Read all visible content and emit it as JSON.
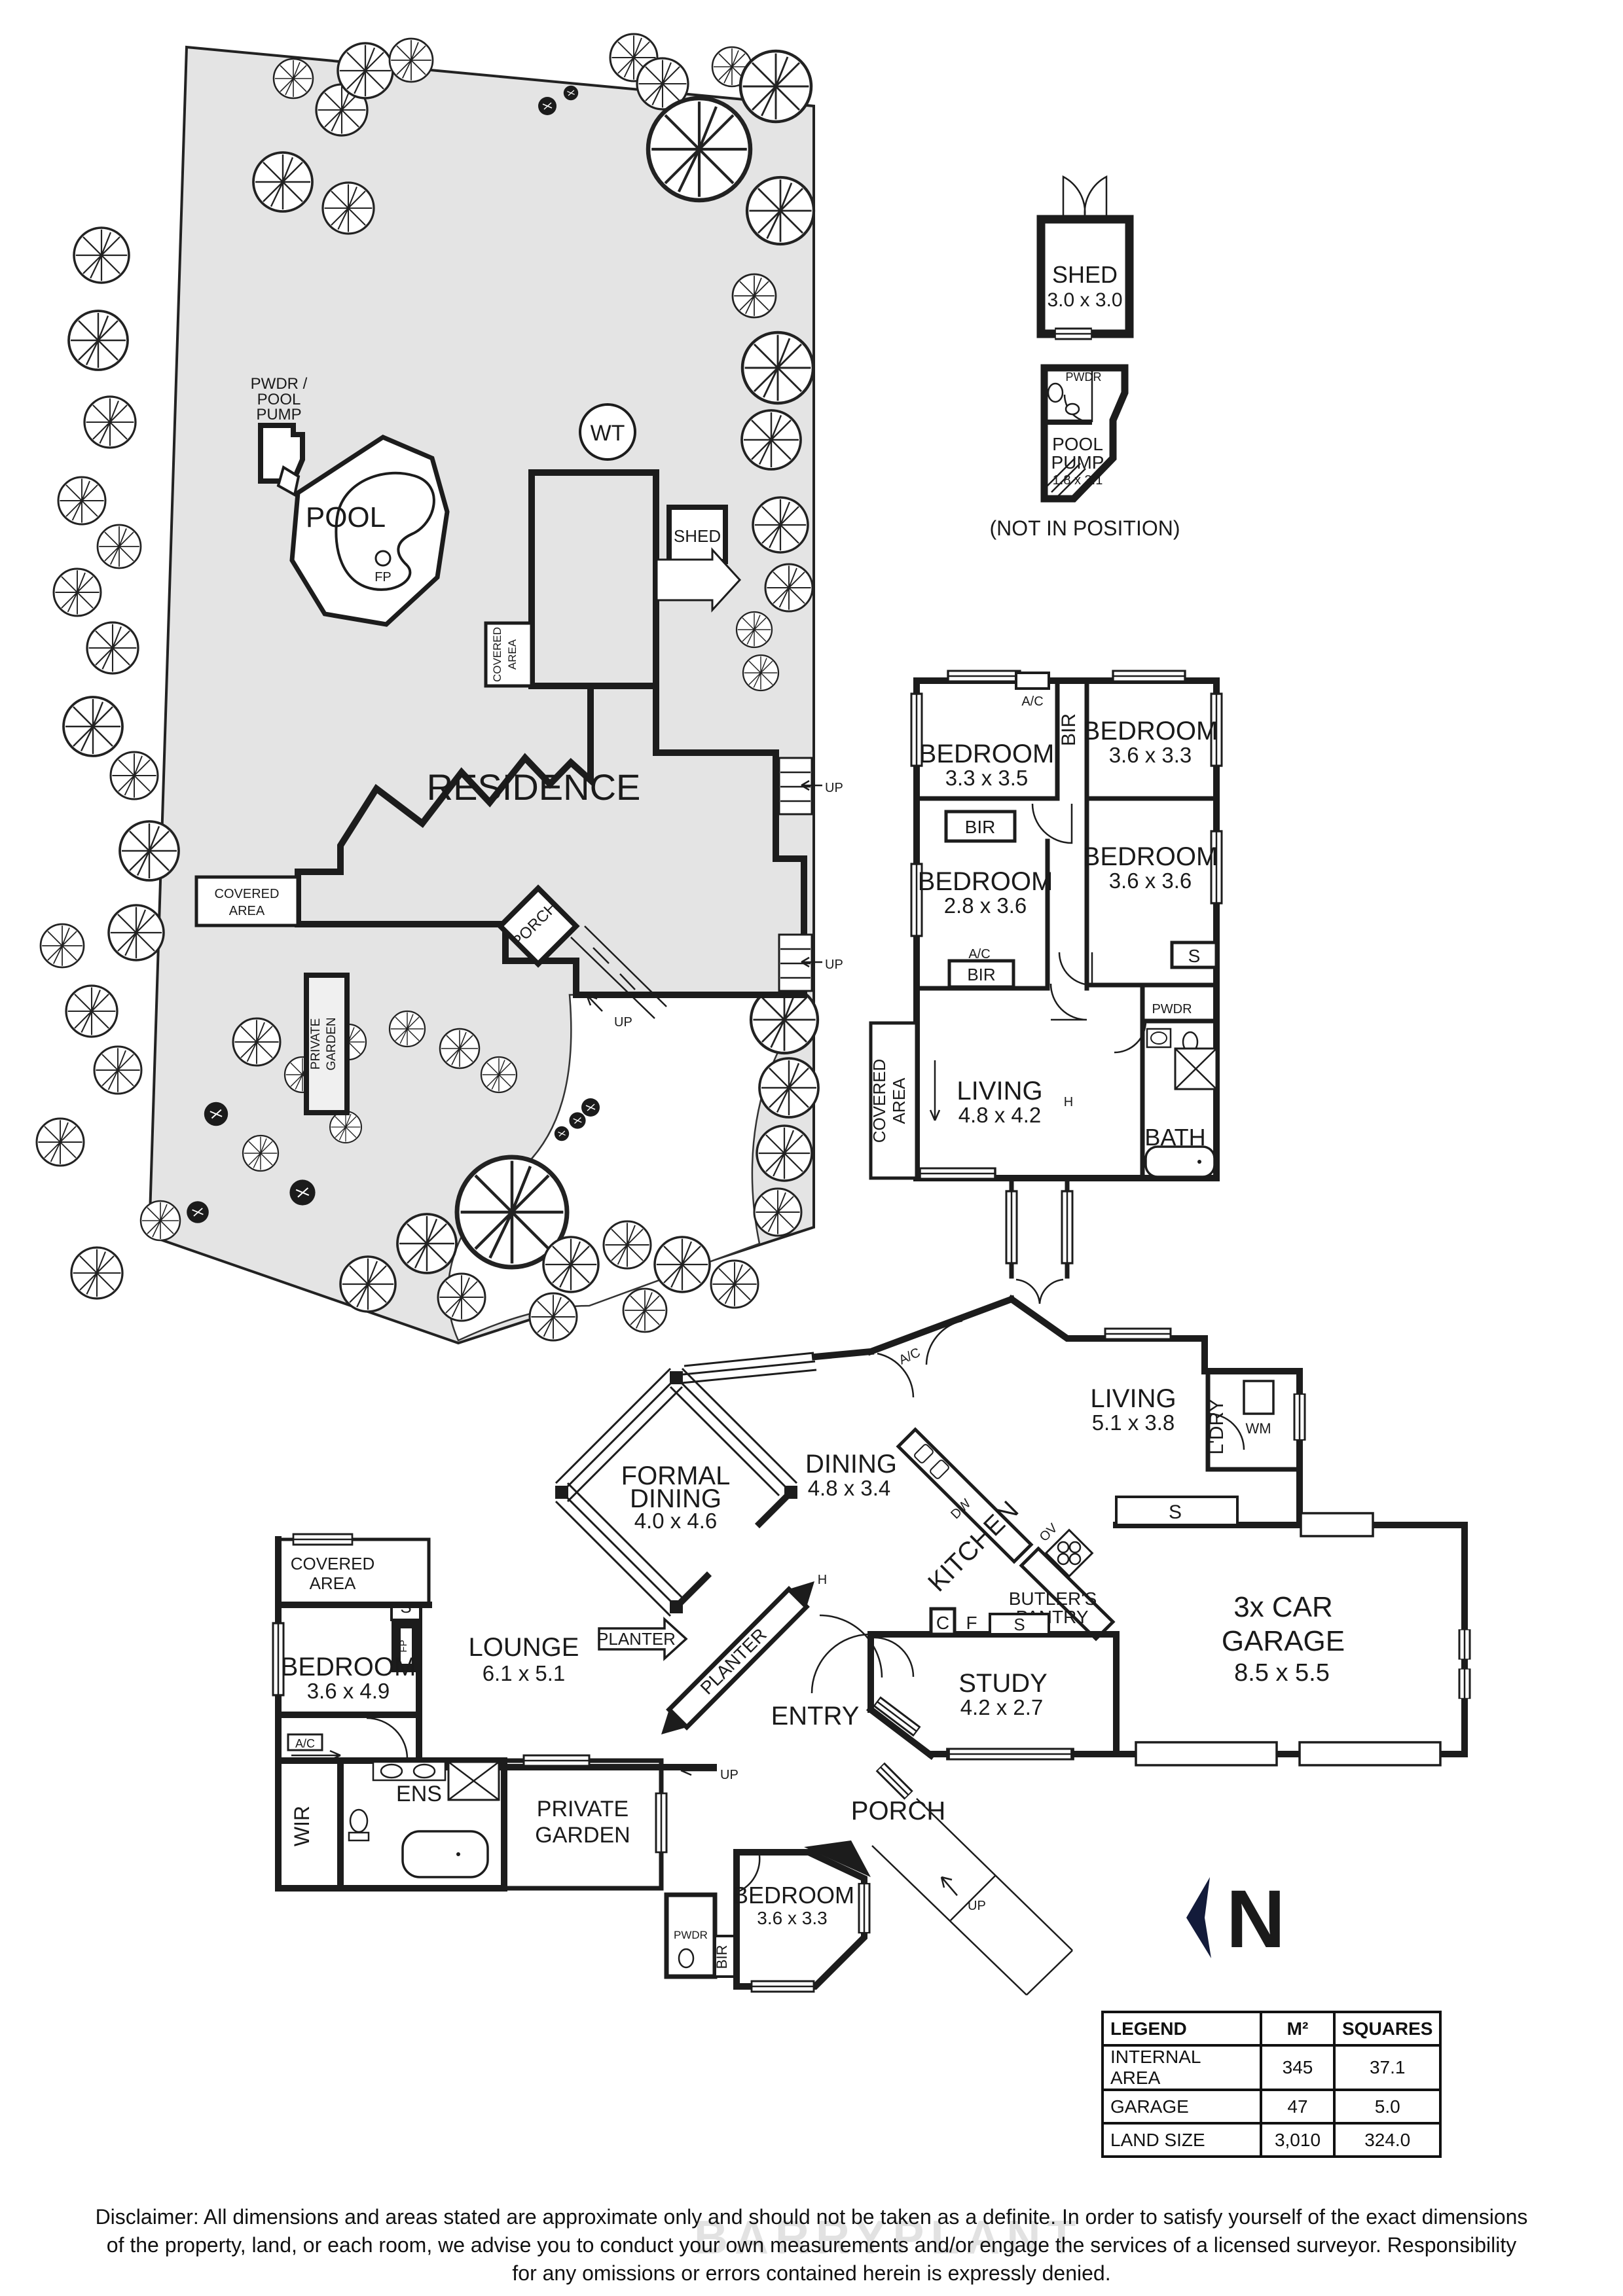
{
  "site": {
    "residence": "RESIDENCE",
    "pool": "POOL",
    "wt": "WT",
    "shed": "SHED",
    "fp": "FP",
    "pwdr_pump": [
      "PWDR /",
      "POOL",
      "PUMP"
    ],
    "covered": [
      "COVERED",
      "AREA"
    ],
    "private_garden": [
      "PRIVATE",
      "GARDEN"
    ],
    "porch": "PORCH",
    "up": "UP"
  },
  "outbuildings": {
    "shed_name": "SHED",
    "shed_dims": "3.0 x 3.0",
    "pump_name": [
      "POOL",
      "PUMP"
    ],
    "pump_dims": "1.8 x 3.1",
    "pwdr": "PWDR",
    "note": "(NOT IN POSITION)"
  },
  "wing": {
    "bedroom": "BEDROOM",
    "bed1_dims": "3.3 x 3.5",
    "bed2_dims": "3.6 x 3.3",
    "bed3_dims": "2.8 x 3.6",
    "bed4_dims": "3.6 x 3.6",
    "living": "LIVING",
    "living_dims": "4.8 x 4.2",
    "bath": "BATH",
    "bir": "BIR",
    "ac": "A/C",
    "s": "S",
    "pwdr": "PWDR",
    "h": "H",
    "covered": [
      "COVERED",
      "AREA"
    ]
  },
  "main": {
    "formal": [
      "FORMAL",
      "DINING"
    ],
    "formal_dims": "4.0 x 4.6",
    "dining": "DINING",
    "dining_dims": "4.8 x 3.4",
    "kitchen": "KITCHEN",
    "dw": "DW",
    "ov": "OV",
    "butlers": [
      "BUTLER'S",
      "PANTRY"
    ],
    "living": "LIVING",
    "living_dims": "5.1 x 3.8",
    "ldry": "L'DRY",
    "wm": "WM",
    "study": "STUDY",
    "study_dims": "4.2 x 2.7",
    "garage": [
      "3x CAR",
      "GARAGE"
    ],
    "garage_dims": "8.5 x 5.5",
    "lounge": "LOUNGE",
    "lounge_dims": "6.1 x 5.1",
    "entry": "ENTRY",
    "porch": "PORCH",
    "planter": "PLANTER",
    "covered": [
      "COVERED",
      "AREA"
    ],
    "bedroom": "BEDROOM",
    "bed5_dims": "3.6 x 4.9",
    "bed6_dims": "3.6 x 3.3",
    "private_garden": [
      "PRIVATE",
      "GARDEN"
    ],
    "wir": "WIR",
    "ens": "ENS",
    "bir": "BIR",
    "pwdr": "PWDR",
    "ac": "A/C",
    "s": "S",
    "c": "C",
    "f": "F",
    "h": "H",
    "fp": "FP",
    "up": "UP"
  },
  "north": "N",
  "legend": {
    "headers": [
      "LEGEND",
      "M²",
      "SQUARES"
    ],
    "rows": [
      [
        "INTERNAL AREA",
        "345",
        "37.1"
      ],
      [
        "GARAGE",
        "47",
        "5.0"
      ],
      [
        "LAND SIZE",
        "3,010",
        "324.0"
      ]
    ]
  },
  "disclaimer": [
    "Disclaimer: All dimensions and areas stated are approximate only and should not be taken as a definite. In order to satisfy yourself of the exact dimensions",
    "of the property, land, or each room, we advise you to conduct your own measurements and/or engage the services of a licensed surveyor. Responsibility",
    "for any omissions or errors contained herein is expressly denied."
  ],
  "watermark": "BARRYPLANT"
}
